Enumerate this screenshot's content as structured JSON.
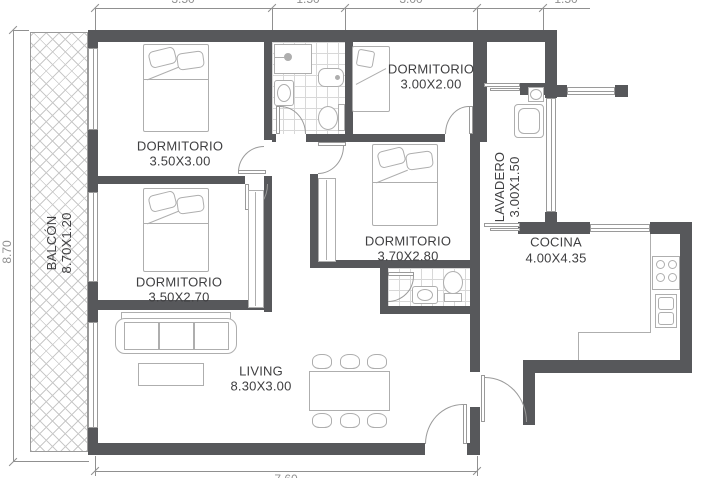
{
  "rooms": {
    "bedroom1": {
      "name": "DORMITORIO",
      "dims": "3.50X3.00"
    },
    "bedroom2": {
      "name": "DORMITORIO",
      "dims": "3.50X2.70"
    },
    "bedroom3": {
      "name": "DORMITORIO",
      "dims": "3.00X2.00"
    },
    "bedroom4": {
      "name": "DORMITORIO",
      "dims": "3.70X2.80"
    },
    "living": {
      "name": "LIVING",
      "dims": "8.30X3.00"
    },
    "kitchen": {
      "name": "COCINA",
      "dims": "4.00X4.35"
    },
    "laundry": {
      "name": "LAVADERO",
      "dims": "3.00X1.50"
    },
    "balcony": {
      "name": "BALCÓN",
      "dims": "8.70X1.20"
    }
  },
  "dimensions": {
    "top": [
      "3.50",
      "1.50",
      "3.00",
      "1.50"
    ],
    "left": "8.70",
    "bottom": "7.60"
  },
  "colors": {
    "wall": "#57585b",
    "line": "#9a9a9a",
    "furniture": "#aeaeae",
    "text": "#3f3f41",
    "dimension": "#909090",
    "tile": "#d8d8d8",
    "hatch": "#c9c9c9"
  }
}
